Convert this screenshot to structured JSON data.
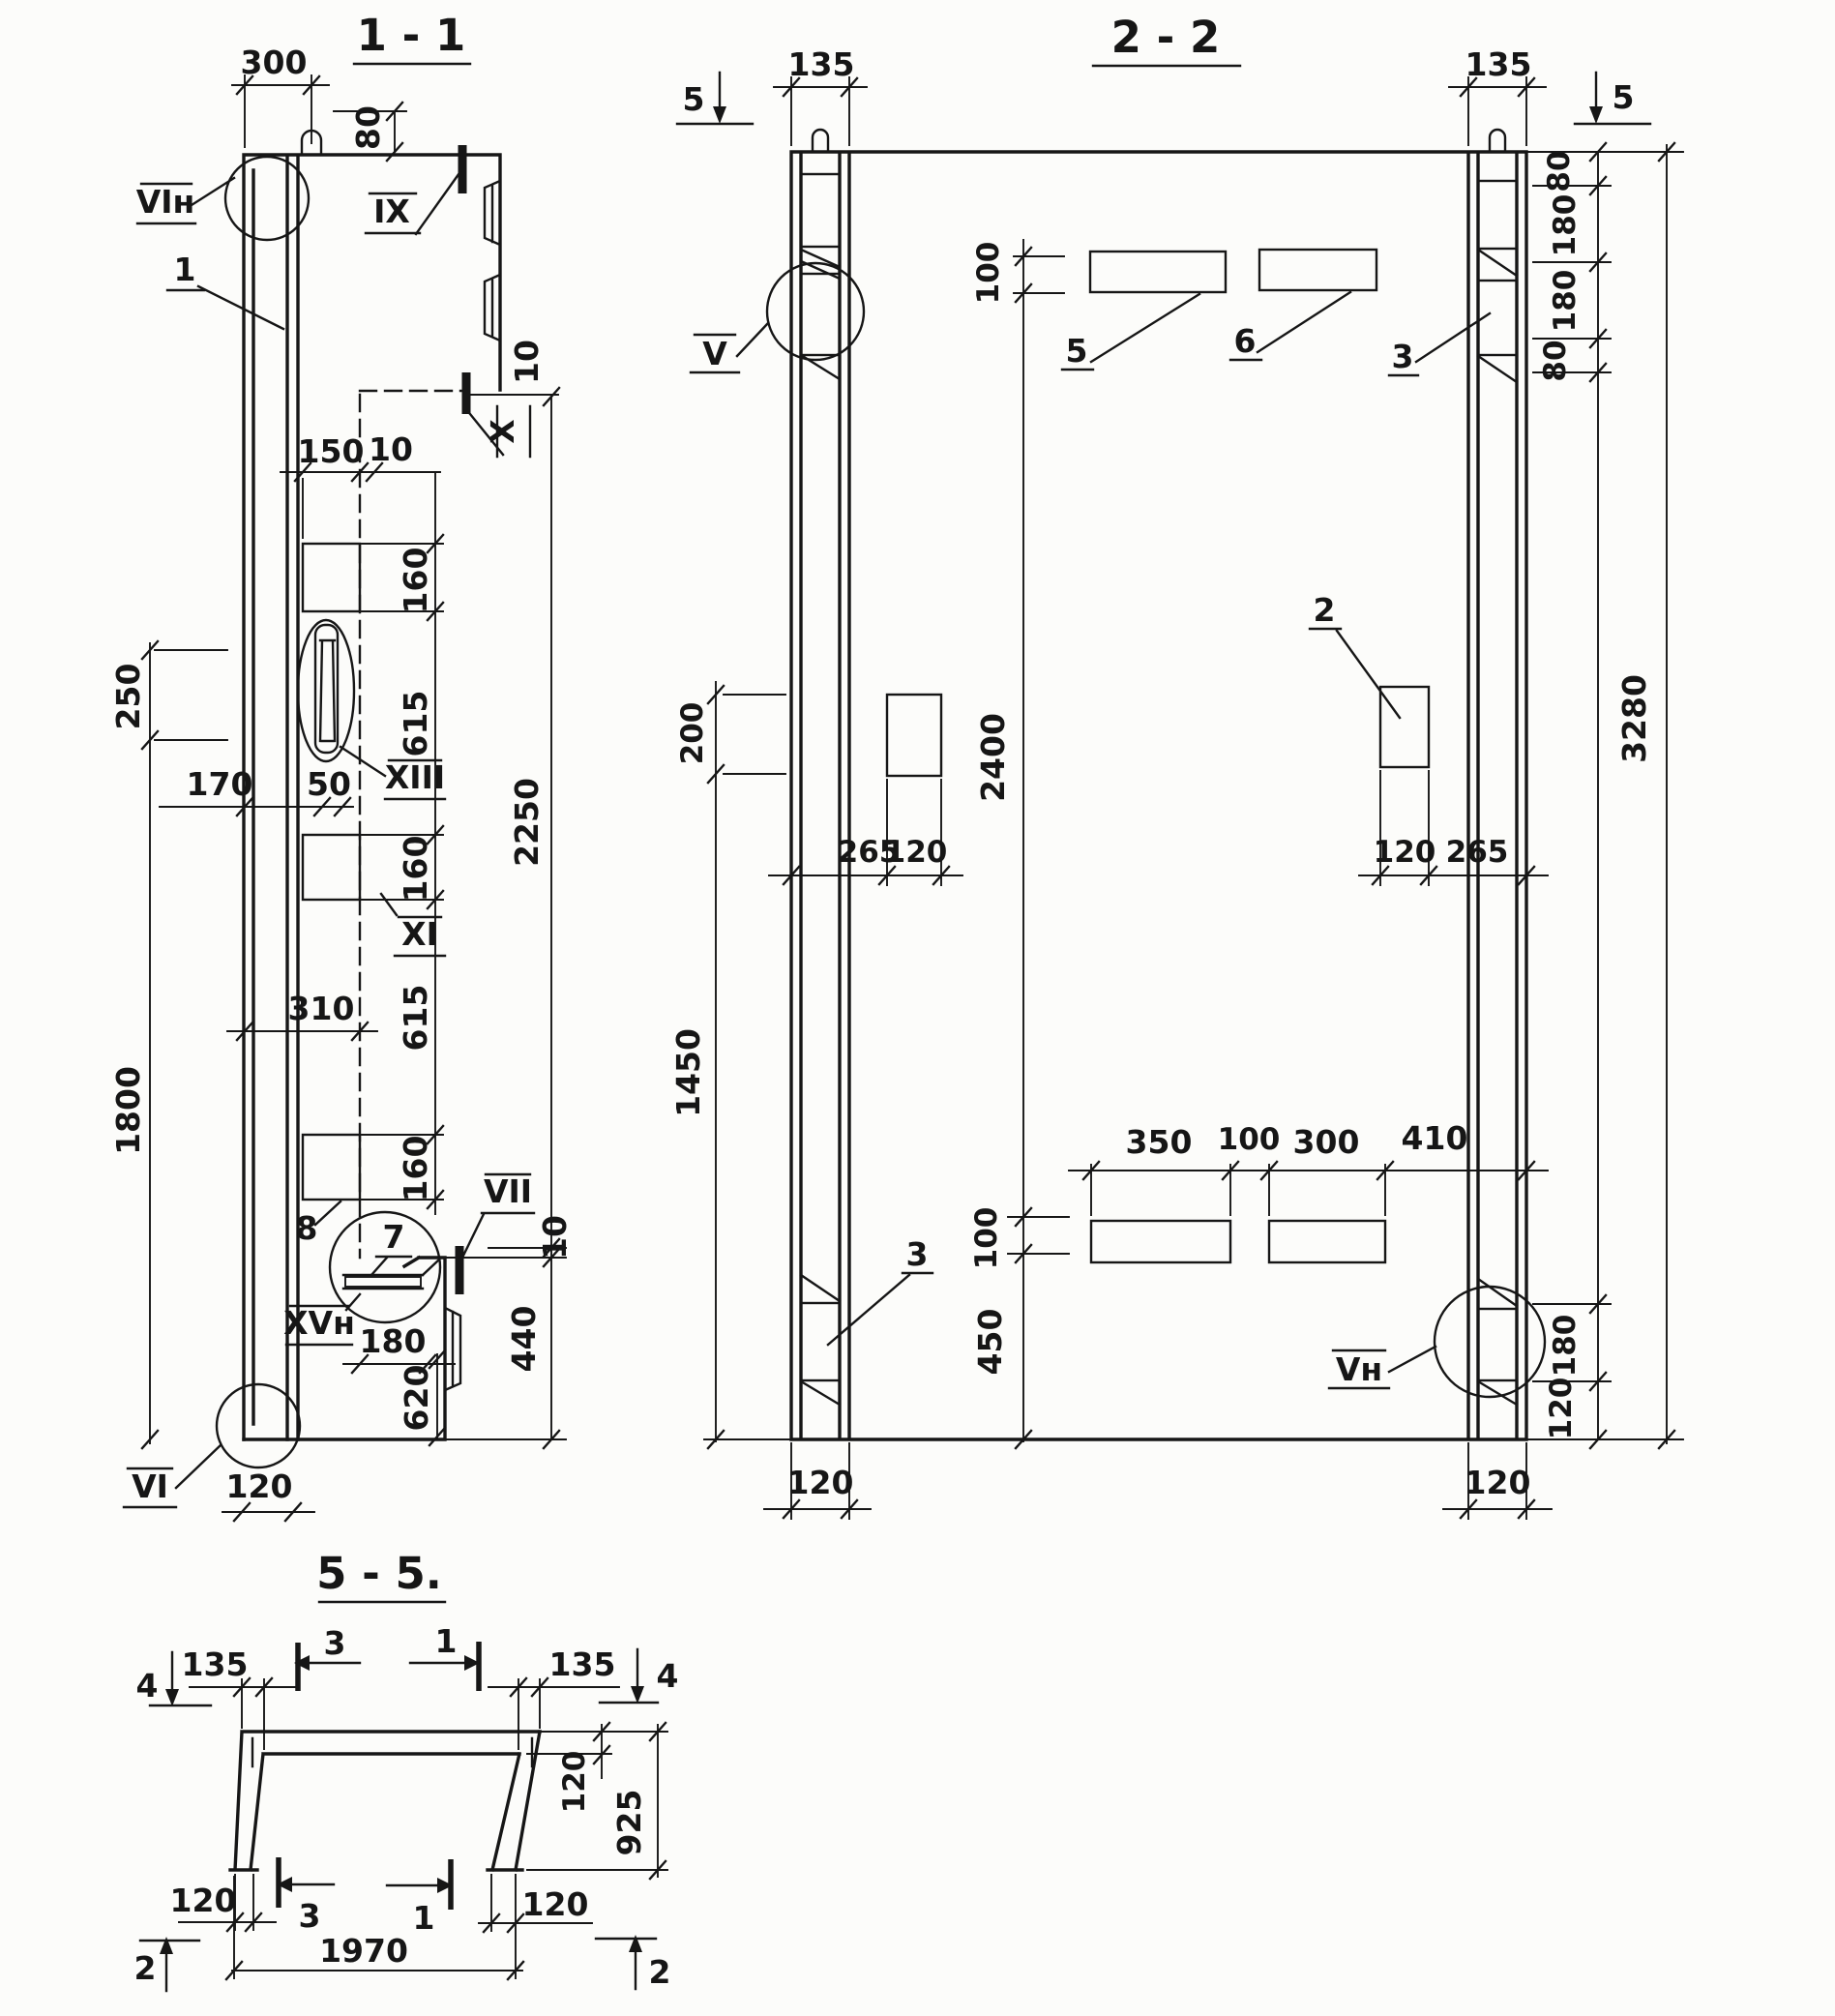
{
  "ink": "#161616",
  "s1": {
    "title": "1 - 1",
    "d300": "300",
    "d80": "80",
    "d10": "10",
    "d150": "150",
    "d160": "160",
    "d615": "615",
    "d250": "250",
    "d1800": "1800",
    "d170": "170",
    "d50": "50",
    "d310": "310",
    "d2250": "2250",
    "d440": "440",
    "d180": "180",
    "d620": "620",
    "d120": "120",
    "n_vin": "VIн",
    "n_ix": "IX",
    "n_1": "1",
    "n_x": "X",
    "n_xiii": "XIII",
    "n_xi": "XI",
    "n_8": "8",
    "n_7": "7",
    "n_vii": "VII",
    "n_xvn": "XVн",
    "n_vi": "VI"
  },
  "s2": {
    "title": "2 - 2",
    "m5": "5",
    "d135": "135",
    "d80": "80",
    "d180": "180",
    "d120": "120",
    "d3280": "3280",
    "d100": "100",
    "d200": "200",
    "d2400": "2400",
    "d1450": "1450",
    "d265": "265",
    "d350": "350",
    "d300": "300",
    "d410": "410",
    "d450": "450",
    "n_v": "V",
    "n_vn": "Vн",
    "n_2": "2",
    "n_3": "3",
    "n_5": "5",
    "n_6": "6"
  },
  "s5": {
    "title": "5 - 5.",
    "m4": "4",
    "m3": "3",
    "m1": "1",
    "m2": "2",
    "d135": "135",
    "d120": "120",
    "d925": "925",
    "d1970": "1970"
  }
}
